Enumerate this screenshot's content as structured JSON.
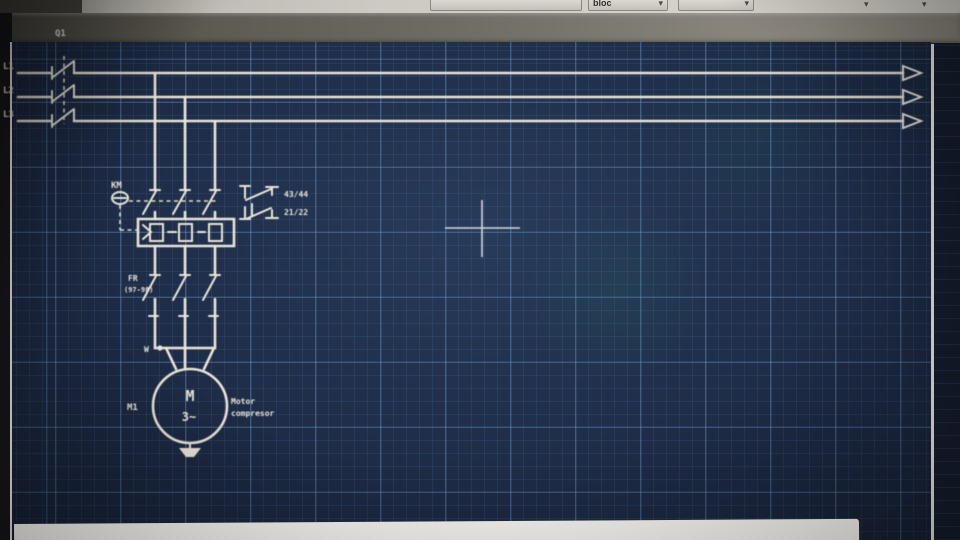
{
  "toolbar": {
    "dropdown_label": "bloc",
    "chevron_icon": "▾"
  },
  "schematic": {
    "phase_labels": [
      "L1",
      "L2",
      "L3"
    ],
    "disconnect_label": "Q1",
    "contactor_label": "KM",
    "aux_no_label": "43/44",
    "aux_nc_label": "21/22",
    "overload_label": "FR",
    "overload_terminals": "(97-98)",
    "junction_label": "W",
    "motor": {
      "letter": "M",
      "phases": "3~",
      "ref": "M1",
      "desc1": "Motor",
      "desc2": "compresor"
    }
  },
  "colors": {
    "canvas_bg": "#1e2c47",
    "grid_minor": "#33496c",
    "grid_major": "#42628a",
    "line": "#eae5d9",
    "cursor": "#d9d9d5",
    "toolbar_strip": "#cdcac2"
  }
}
